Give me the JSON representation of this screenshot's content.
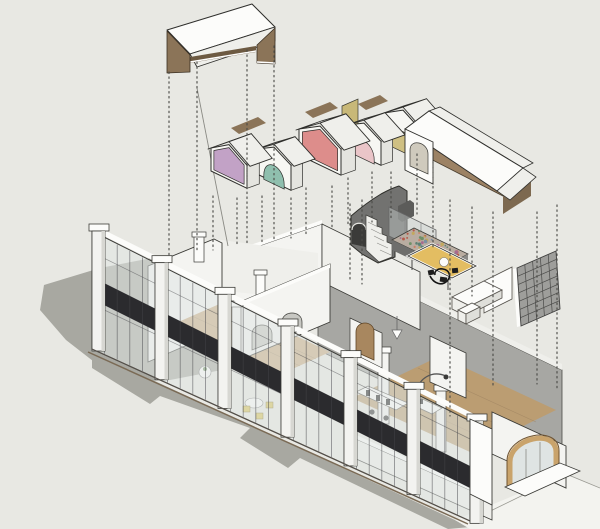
{
  "figure": {
    "kind": "exploded-axonometric-architecture-diagram",
    "description_tokens": [
      "exploded roof canopy",
      "vault roof modules",
      "gable attic roof",
      "stair volume",
      "mezzanine",
      "glass curtain facade",
      "arched niche"
    ]
  },
  "palette": {
    "bg": "#e8e8e3",
    "ground_light": "#f3f3ef",
    "shadow": "#a8a8a1",
    "outline": "#2f2f2c",
    "white": "#fcfcfa",
    "white_dim": "#efefeb",
    "white_shade": "#dfdfda",
    "white_wall": "#f4f4f1",
    "glass": "rgba(224,230,228,0.55)",
    "glass_panel": "rgba(200,206,204,0.45)",
    "dark_band": "#2b2b2e",
    "mullion": "#45454a",
    "gray_wall": "#a7a7a3",
    "gray_light": "#c9c9c5",
    "opening_shade": "#c7c7c2",
    "stair_dark": "#727270",
    "stair_deep": "#3b3b39",
    "stair_block": "#5c5c5a",
    "brown_panel": "#8b7458",
    "brown_dark": "#6d5a42",
    "attic_floor": "#9c8264",
    "attic_face": "#7d6950",
    "wood_floor": "#c9ac82",
    "wood_floor2": "#bb9d72",
    "plank": "#9a7f5d",
    "platform_wood": "#e3bd62",
    "arch_wood": "#c9a36b",
    "arch_wood_dark": "#6f5330",
    "arch_glass": "#dfe4e3",
    "door_wood": "#a8875f",
    "furniture_yellow": "#d9c356",
    "black_item": "#1d1d1d",
    "dot_line": "#4c4c48"
  },
  "vault_houses": [
    {
      "name": "vault-house-khaki",
      "color": "#cfc083",
      "opening": "arch",
      "x": 384,
      "y": 141,
      "w": 38,
      "wall": 28,
      "peak": 12
    },
    {
      "name": "vault-house-pink",
      "color": "#eac5c8",
      "opening": "arch",
      "x": 347,
      "y": 149,
      "w": 34,
      "wall": 24,
      "peak": 10
    },
    {
      "name": "vault-house-red",
      "color": "#dd8d8b",
      "opening": "flat",
      "x": 299,
      "y": 155,
      "w": 42,
      "wall": 26,
      "peak": 13
    },
    {
      "name": "vault-house-teal",
      "color": "#8fbfae",
      "opening": "arch",
      "x": 257,
      "y": 174,
      "w": 34,
      "wall": 25,
      "peak": 10
    },
    {
      "name": "vault-house-purple",
      "color": "#c2a2c6",
      "opening": "flat",
      "x": 211,
      "y": 171,
      "w": 36,
      "wall": 23,
      "peak": 12
    }
  ],
  "dotted_lines": [
    [
      169,
      72,
      256
    ],
    [
      197,
      62,
      250
    ],
    [
      247,
      50,
      246
    ],
    [
      274,
      46,
      242
    ],
    [
      213,
      196,
      250
    ],
    [
      237,
      198,
      247
    ],
    [
      262,
      196,
      242
    ],
    [
      291,
      198,
      238
    ],
    [
      306,
      188,
      234
    ],
    [
      332,
      186,
      230
    ],
    [
      348,
      178,
      226
    ],
    [
      372,
      172,
      222
    ],
    [
      391,
      172,
      218
    ],
    [
      417,
      154,
      214
    ],
    [
      350,
      204,
      280
    ],
    [
      362,
      200,
      284
    ],
    [
      433,
      162,
      250
    ],
    [
      450,
      200,
      416
    ],
    [
      472,
      207,
      296
    ],
    [
      493,
      212,
      388
    ],
    [
      537,
      212,
      384
    ],
    [
      557,
      205,
      388
    ]
  ],
  "facade": {
    "pilaster_xs": [
      92,
      155,
      218,
      281,
      344,
      407,
      470
    ],
    "mullion_step": 12.6,
    "rail_fracs": [
      0.18,
      0.62
    ]
  },
  "grid_panel": {
    "rows": 7,
    "cols": 5
  },
  "mezzanine": {
    "speckle_count": 55,
    "speckle_colors": [
      "#b4594a",
      "#6f9068",
      "#c2a85e",
      "#7b90a2",
      "#cc8068",
      "#5e8274",
      "#a86a8f"
    ]
  }
}
